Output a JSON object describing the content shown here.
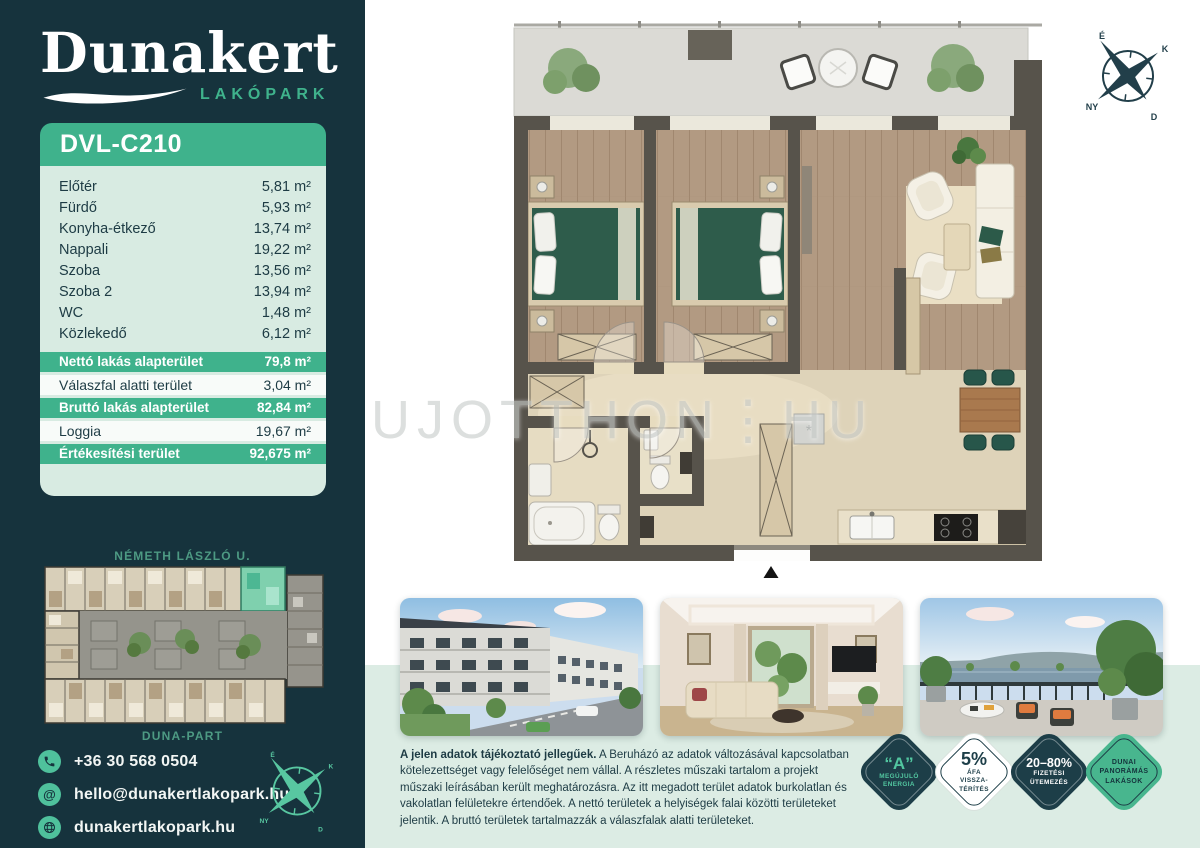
{
  "colors": {
    "accent_green": "#3FB28C",
    "dark_teal": "#16333D",
    "mint": "#D8EBE2",
    "badge_green": "#48B68E"
  },
  "sidebar": {
    "logo": {
      "name": "Dunakert",
      "subtitle": "LAKÓPARK"
    },
    "unit_code": "DVL-C210",
    "rooms": [
      {
        "label": "Előtér",
        "value": "5,81 m²"
      },
      {
        "label": "Fürdő",
        "value": "5,93 m²"
      },
      {
        "label": "Konyha-étkező",
        "value": "13,74 m²"
      },
      {
        "label": "Nappali",
        "value": "19,22 m²"
      },
      {
        "label": "Szoba",
        "value": "13,56 m²"
      },
      {
        "label": "Szoba 2",
        "value": "13,94 m²"
      },
      {
        "label": "WC",
        "value": "1,48 m²"
      },
      {
        "label": "Közlekedő",
        "value": "6,12 m²"
      }
    ],
    "totals": [
      {
        "label": "Nettó lakás alapterület",
        "value": "79,8 m²",
        "highlight": true
      },
      {
        "label": "Válaszfal alatti terület",
        "value": "3,04 m²",
        "highlight": false
      },
      {
        "label": "Bruttó lakás alapterület",
        "value": "82,84 m²",
        "highlight": true
      },
      {
        "label": "Loggia",
        "value": "19,67 m²",
        "highlight": false
      },
      {
        "label": "Értékesítési terület",
        "value": "92,675 m²",
        "highlight": true
      }
    ],
    "siteplan": {
      "street_top": "NÉMETH LÁSZLÓ U.",
      "street_bottom": "DUNA-PART"
    },
    "contact": {
      "phone": "+36 30 568 0504",
      "email": "hello@dunakertlakopark.hu",
      "website": "dunakertlakopark.hu",
      "at_glyph": "@"
    }
  },
  "main": {
    "watermark": "UJOTTHON⋮HU",
    "compass": {
      "n": "É",
      "e": "K",
      "s": "D",
      "w": "NY"
    },
    "disclaimer_bold": "A jelen adatok tájékoztató jellegűek.",
    "disclaimer_rest": " A Beruházó az adatok változásával kapcsolatban kötelezettséget vagy felelőséget nem vállal. A részletes műszaki tartalom a projekt műszaki leírásában került meghatározásra. Az itt megadott terület adatok burkolatlan és vakolatlan felületekre értendőek. A nettó területek a helyiségek falai közötti területeket jelentik. A bruttó területek tartalmazzák a válaszfalak alatti területeket.",
    "badges": [
      {
        "big": "“A”",
        "lines": [
          "MEGÚJULÓ",
          "ENERGIA"
        ]
      },
      {
        "big": "5%",
        "lines": [
          "ÁFA",
          "VISSZA-",
          "TÉRÍTÉS"
        ]
      },
      {
        "big": "20–80%",
        "lines": [
          "FIZETÉSI",
          "ÜTEMEZÉS"
        ]
      },
      {
        "big": "",
        "lines": [
          "DUNAI",
          "PANORÁMÁS",
          "LAKÁSOK"
        ]
      }
    ],
    "photos": [
      {
        "name": "exterior-street-view"
      },
      {
        "name": "living-room-interior"
      },
      {
        "name": "danube-panorama-terrace"
      }
    ]
  }
}
